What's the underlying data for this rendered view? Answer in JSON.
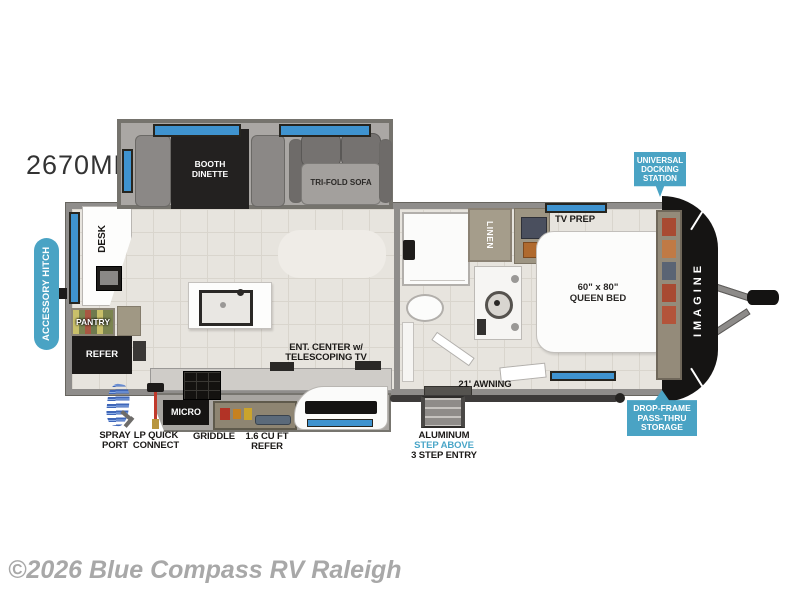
{
  "model": "2670MK",
  "copyright": "©2026 Blue Compass RV Raleigh",
  "brand": "IMAGINE",
  "colors": {
    "badge_blue": "#4aa3c4",
    "window_blue": "#3f93cf",
    "step_above_blue": "#4aa6c8",
    "wall_gray": "#8f8d8b",
    "floor_tile": "#e7e4de",
    "front_cap_black": "#151413"
  },
  "badges": {
    "accessory_hitch": "ACCESSORY HITCH",
    "universal_docking": [
      "UNIVERSAL",
      "DOCKING",
      "STATION"
    ],
    "drop_frame": [
      "DROP-FRAME",
      "PASS-THRU",
      "STORAGE"
    ]
  },
  "rooms": {
    "booth_dinette": [
      "BOOTH",
      "DINETTE"
    ],
    "tri_fold_sofa": "TRI-FOLD SOFA",
    "desk": "DESK",
    "pantry": "PANTRY",
    "refer": "REFER",
    "linen": "LINEN",
    "tv_prep": "TV PREP",
    "queen_bed": [
      "60\" x 80\"",
      "QUEEN BED"
    ]
  },
  "kitchen": {
    "ent_center": [
      "ENT. CENTER w/",
      "TELESCOPING TV"
    ],
    "micro": "MICRO",
    "griddle": "GRIDDLE",
    "small_refer": [
      "1.6 CU FT",
      "REFER"
    ]
  },
  "exterior": {
    "awning": "21' AWNING",
    "spray_port": [
      "SPRAY",
      "PORT"
    ],
    "lp_quick_connect": [
      "LP QUICK",
      "CONNECT"
    ],
    "entry_steps": [
      "ALUMINUM",
      "STEP ABOVE",
      "3 STEP ENTRY"
    ]
  }
}
